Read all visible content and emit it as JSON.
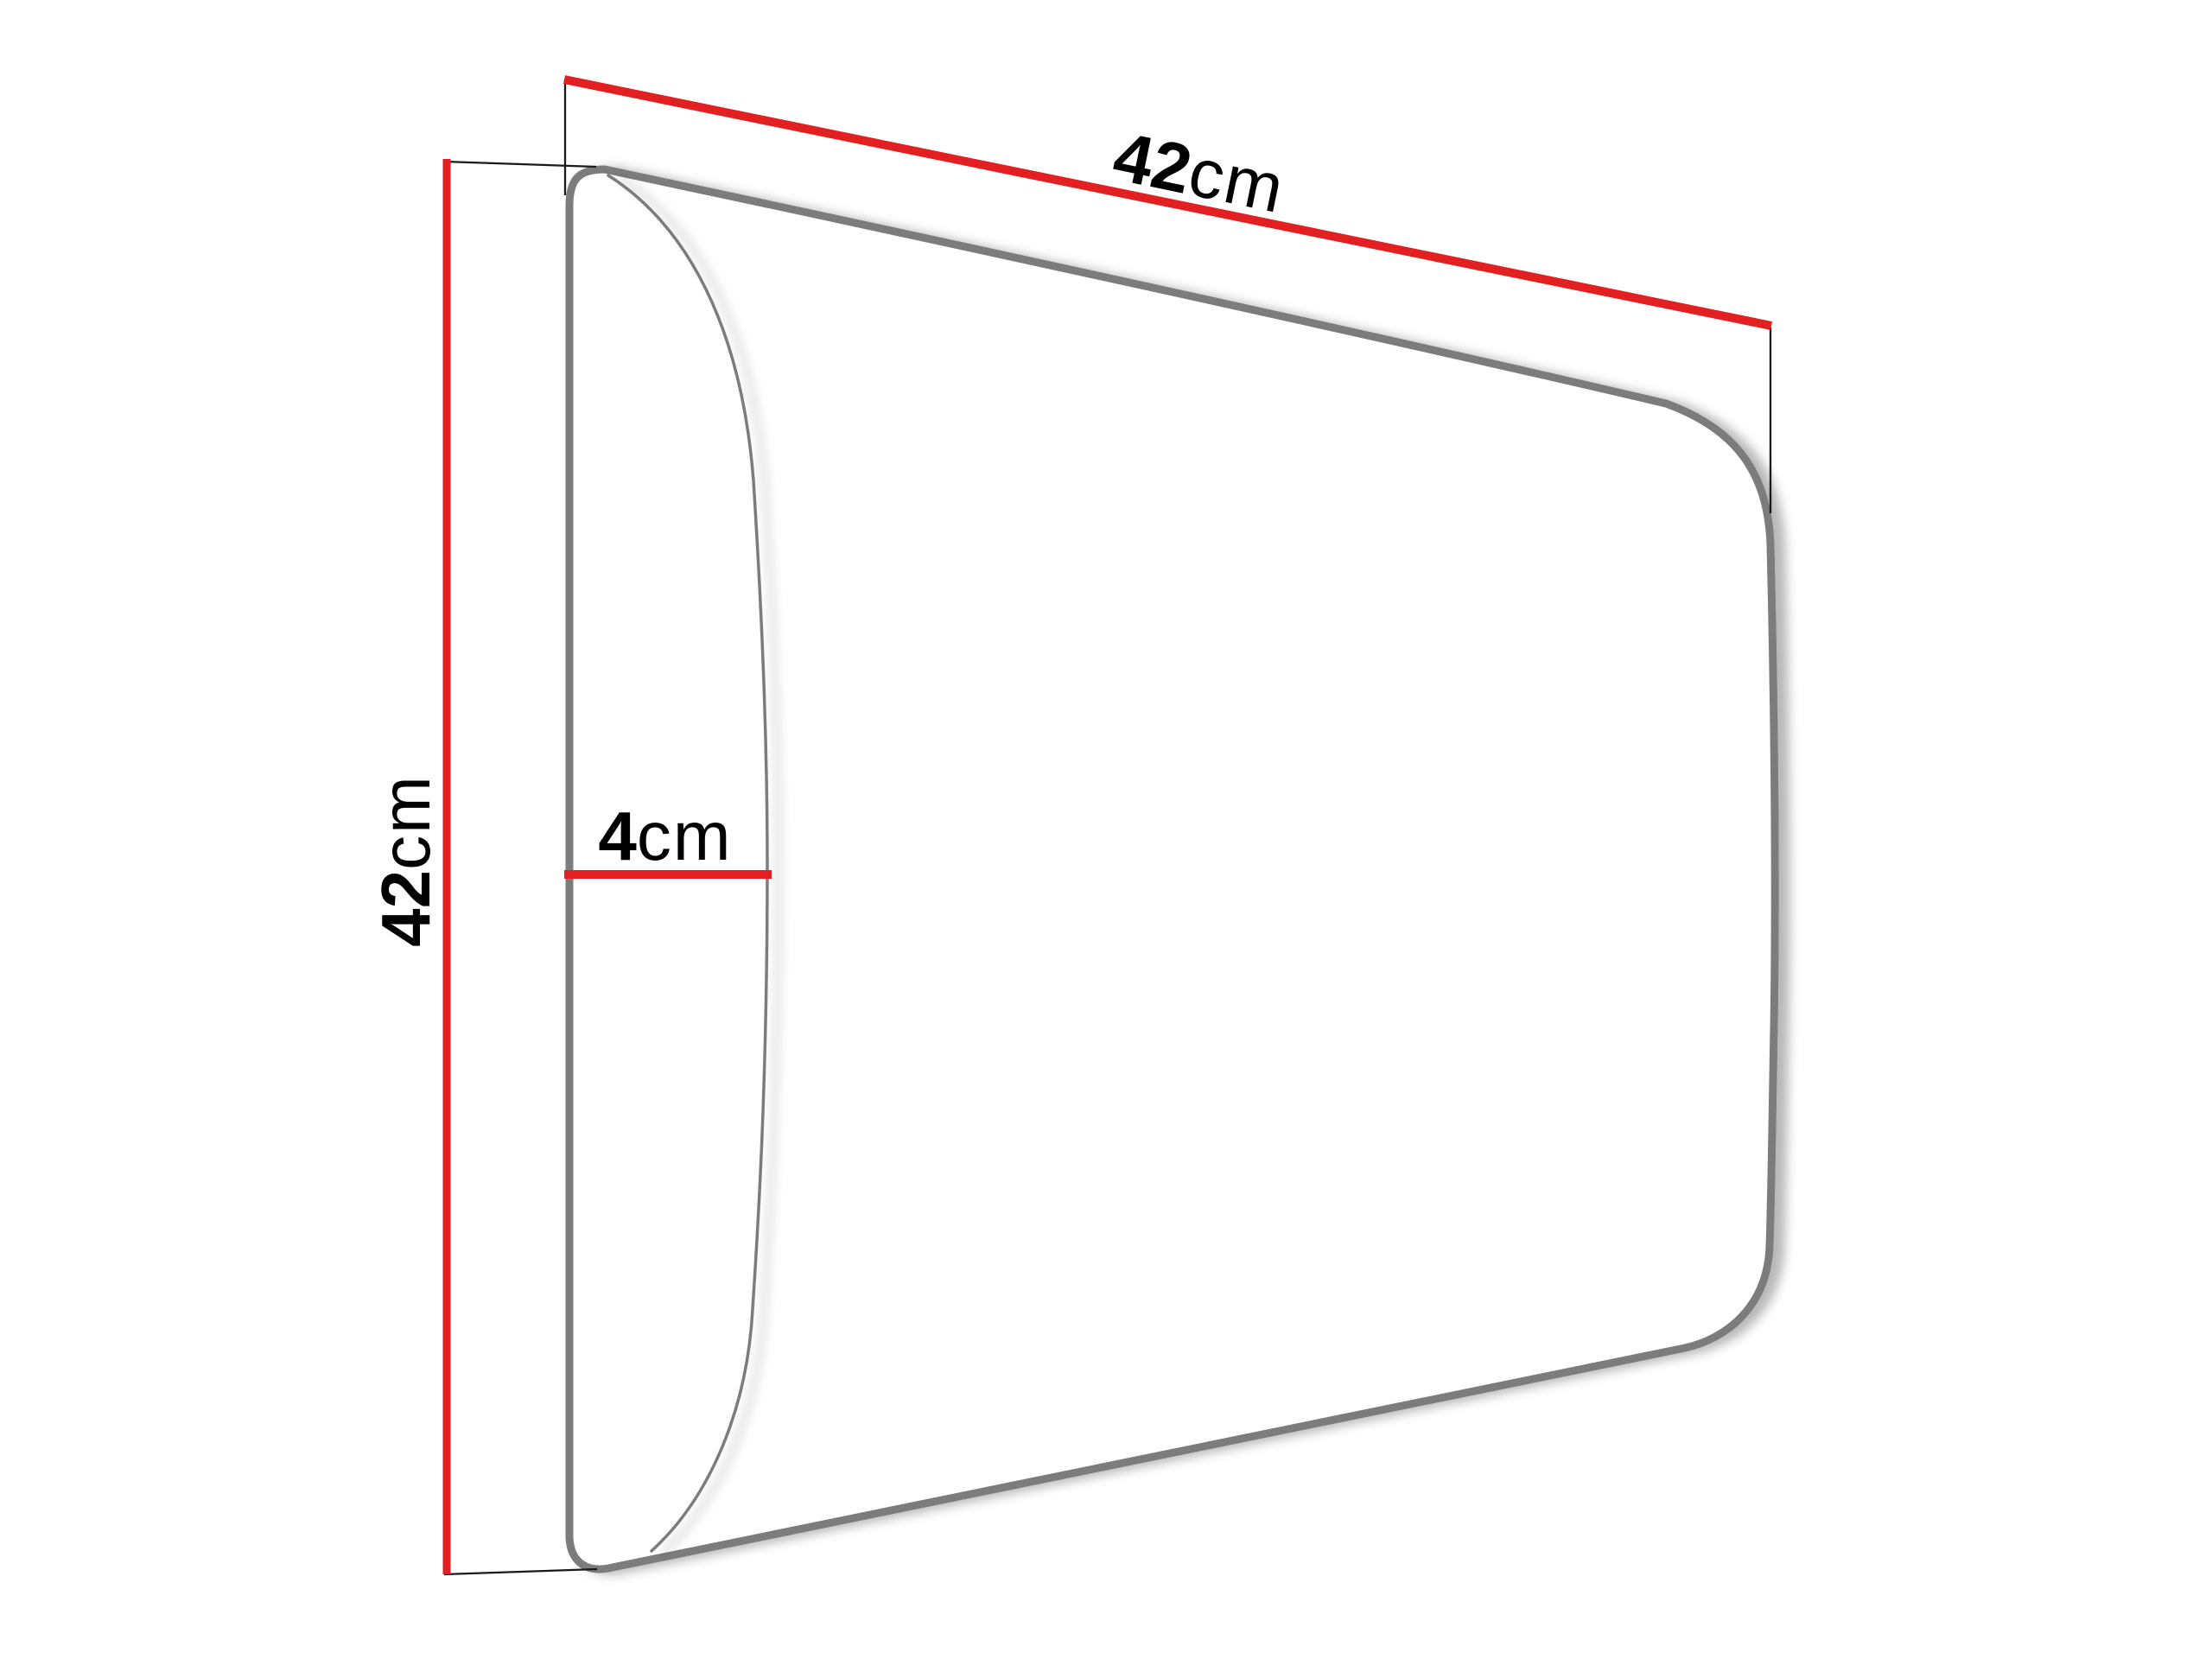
{
  "diagram": {
    "dimensions": {
      "width": {
        "value": "42",
        "unit": "cm"
      },
      "height": {
        "value": "42",
        "unit": "cm"
      },
      "depth": {
        "value": "4",
        "unit": "cm"
      }
    },
    "colors": {
      "dimension_line": "#e32021",
      "panel_outline": "#7b7b7b",
      "cushion_edge": "#7b7b7b",
      "extension_line": "#1a1a1a",
      "label_text": "#000000",
      "background": "#ffffff"
    }
  }
}
